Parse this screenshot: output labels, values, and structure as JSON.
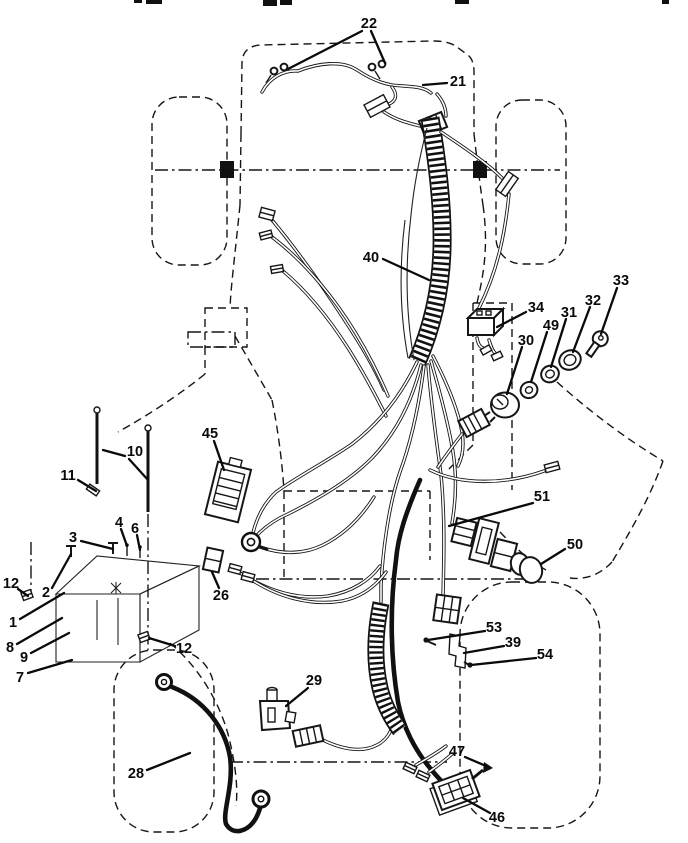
{
  "figure": {
    "type": "exploded-parts-diagram",
    "subject": "tractor electrical wiring harness line drawing",
    "background_color": "#ffffff",
    "ink_color": "#111111"
  },
  "callouts": [
    {
      "n": "22",
      "x": 369,
      "y": 24,
      "leaders": [
        [
          362,
          31,
          288,
          69
        ],
        [
          371,
          31,
          385,
          63
        ]
      ]
    },
    {
      "n": "21",
      "x": 458,
      "y": 82,
      "leaders": [
        [
          447,
          83,
          423,
          85
        ]
      ]
    },
    {
      "n": "40",
      "x": 371,
      "y": 258,
      "leaders": [
        [
          383,
          259,
          429,
          280
        ]
      ]
    },
    {
      "n": "34",
      "x": 536,
      "y": 308,
      "leaders": [
        [
          526,
          312,
          497,
          327
        ]
      ]
    },
    {
      "n": "30",
      "x": 526,
      "y": 341,
      "leaders": [
        [
          522,
          347,
          507,
          394
        ]
      ]
    },
    {
      "n": "49",
      "x": 551,
      "y": 326,
      "leaders": [
        [
          547,
          332,
          531,
          382
        ]
      ]
    },
    {
      "n": "31",
      "x": 569,
      "y": 313,
      "leaders": [
        [
          566,
          319,
          551,
          367
        ]
      ]
    },
    {
      "n": "32",
      "x": 593,
      "y": 301,
      "leaders": [
        [
          590,
          307,
          573,
          352
        ]
      ]
    },
    {
      "n": "33",
      "x": 621,
      "y": 281,
      "leaders": [
        [
          617,
          288,
          601,
          334
        ]
      ]
    },
    {
      "n": "45",
      "x": 210,
      "y": 434,
      "leaders": [
        [
          214,
          441,
          224,
          470
        ]
      ]
    },
    {
      "n": "10",
      "x": 135,
      "y": 452,
      "leaders": [
        [
          125,
          456,
          103,
          450
        ],
        [
          129,
          459,
          148,
          480
        ]
      ]
    },
    {
      "n": "11",
      "x": 68,
      "y": 476,
      "leaders": [
        [
          78,
          480,
          96,
          491
        ]
      ]
    },
    {
      "n": "4",
      "x": 119,
      "y": 523,
      "leaders": [
        [
          121,
          529,
          127,
          546
        ]
      ]
    },
    {
      "n": "6",
      "x": 135,
      "y": 529,
      "leaders": [
        [
          137,
          535,
          140,
          550
        ]
      ]
    },
    {
      "n": "3",
      "x": 73,
      "y": 538,
      "leaders": [
        [
          81,
          541,
          113,
          549
        ]
      ]
    },
    {
      "n": "12",
      "x": 11,
      "y": 584,
      "leaders": [
        [
          18,
          589,
          28,
          596
        ]
      ]
    },
    {
      "n": "2",
      "x": 46,
      "y": 593,
      "leaders": [
        [
          52,
          588,
          71,
          554
        ]
      ]
    },
    {
      "n": "1",
      "x": 13,
      "y": 623,
      "leaders": [
        [
          20,
          619,
          64,
          593
        ]
      ]
    },
    {
      "n": "8",
      "x": 10,
      "y": 648,
      "leaders": [
        [
          17,
          644,
          62,
          618
        ]
      ]
    },
    {
      "n": "9",
      "x": 24,
      "y": 658,
      "leaders": [
        [
          31,
          653,
          69,
          633
        ]
      ]
    },
    {
      "n": "7",
      "x": 20,
      "y": 678,
      "leaders": [
        [
          28,
          673,
          72,
          660
        ]
      ]
    },
    {
      "n": "12",
      "x": 184,
      "y": 649,
      "leaders": [
        [
          175,
          646,
          149,
          638
        ]
      ]
    },
    {
      "n": "26",
      "x": 221,
      "y": 596,
      "leaders": [
        [
          219,
          588,
          212,
          572
        ]
      ]
    },
    {
      "n": "51",
      "x": 542,
      "y": 497,
      "leaders": [
        [
          533,
          503,
          449,
          526
        ]
      ]
    },
    {
      "n": "50",
      "x": 575,
      "y": 545,
      "leaders": [
        [
          565,
          549,
          541,
          564
        ]
      ]
    },
    {
      "n": "53",
      "x": 494,
      "y": 628,
      "leaders": [
        [
          485,
          631,
          428,
          640
        ]
      ],
      "dot": [
        426,
        640
      ]
    },
    {
      "n": "39",
      "x": 513,
      "y": 643,
      "leaders": [
        [
          504,
          646,
          464,
          653
        ]
      ]
    },
    {
      "n": "54",
      "x": 545,
      "y": 655,
      "leaders": [
        [
          536,
          658,
          471,
          665
        ]
      ],
      "dot": [
        470,
        665
      ]
    },
    {
      "n": "29",
      "x": 314,
      "y": 681,
      "leaders": [
        [
          308,
          688,
          286,
          706
        ]
      ]
    },
    {
      "n": "28",
      "x": 136,
      "y": 774,
      "leaders": [
        [
          147,
          770,
          190,
          753
        ]
      ]
    },
    {
      "n": "47",
      "x": 457,
      "y": 752,
      "leaders": [
        [
          465,
          757,
          486,
          766
        ]
      ]
    },
    {
      "n": "46",
      "x": 497,
      "y": 818,
      "leaders": [
        [
          490,
          813,
          463,
          798
        ]
      ]
    }
  ]
}
